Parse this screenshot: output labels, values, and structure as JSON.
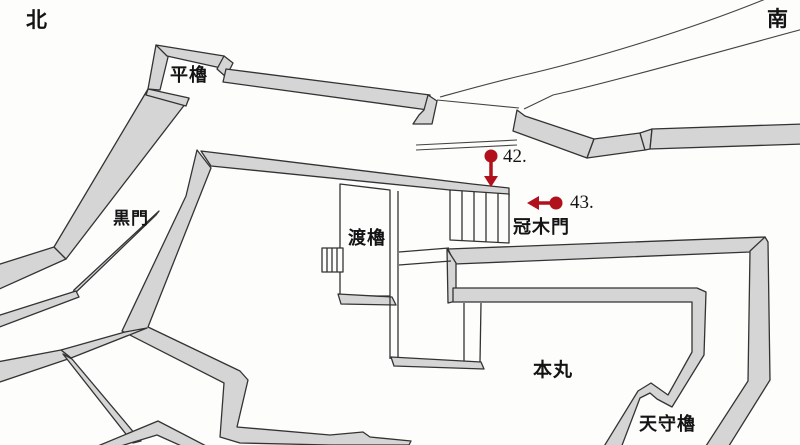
{
  "map": {
    "title": "castle-grounds-plan",
    "compass": {
      "north": "北",
      "south": "南"
    },
    "labels": {
      "hirayagura": "平櫓",
      "kuromon": "黒門",
      "watariyagura": "渡櫓",
      "kabukimon": "冠木門",
      "honmaru": "本丸",
      "tenshuyagura": "天守櫓"
    },
    "markers": [
      {
        "id": "42",
        "label": "42."
      },
      {
        "id": "43",
        "label": "43."
      }
    ],
    "colors": {
      "marker_red": "#b0111c",
      "wall_fill": "#d5d5d5",
      "wall_line": "#333333",
      "paper": "#fdfdfb"
    }
  }
}
